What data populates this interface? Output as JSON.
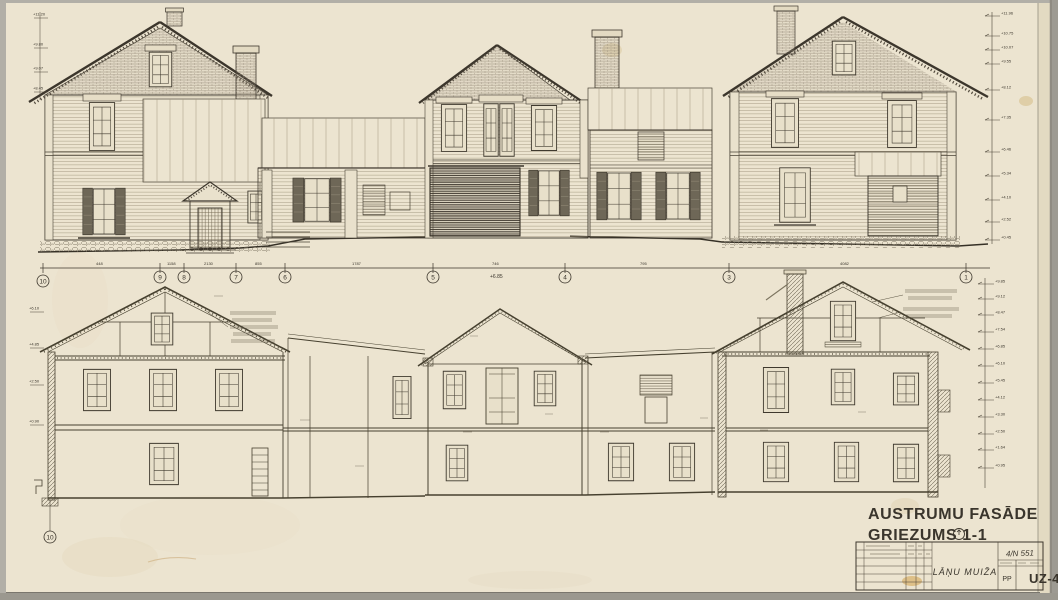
{
  "sheet": {
    "title_line1": "AUSTRUMU FASĀDE",
    "title_line2": "GRIEZUMS 1-1"
  },
  "title_block": {
    "project": "LĀŅU MUIŽA",
    "stage": "PP",
    "sheet_number": "UZ-4",
    "archive_ref": "4/N 551"
  },
  "axes": {
    "labels": [
      "10",
      "9",
      "8",
      "7",
      "6",
      "5",
      "4",
      "3",
      "1"
    ],
    "section_bottom_label": "10"
  },
  "dimensions": {
    "segments": [
      "448",
      "1158",
      "2130",
      "855",
      "1787",
      "746",
      "795",
      "4082"
    ],
    "note": "+6.85"
  },
  "levels": {
    "facade_right": [
      "+11.96",
      "+10.75",
      "+10.07",
      "+9.55",
      "+8.12",
      "+7.35",
      "+6.46",
      "+5.34",
      "+4.10",
      "+2.52",
      "+0.45"
    ],
    "facade_left": [
      "+11.20",
      "+9.80",
      "+9.07",
      "+8.45"
    ],
    "section_right": [
      "+9.85",
      "+9.12",
      "+8.47",
      "+7.54",
      "+6.85",
      "+6.10",
      "+5.45",
      "+4.12",
      "+3.30",
      "+2.50",
      "+1.64",
      "+0.95"
    ],
    "section_left": [
      "+6.10",
      "+4.85",
      "+2.50",
      "+0.90"
    ]
  }
}
